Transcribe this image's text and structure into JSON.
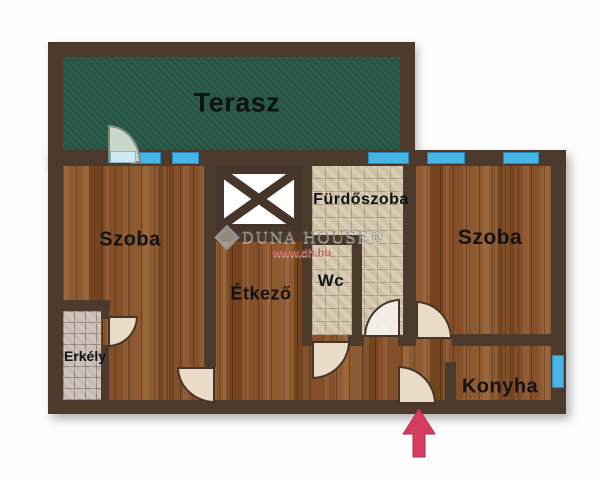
{
  "watermark": {
    "brand_display": "DUNA HOUSE®",
    "url": "www.dh.hu"
  },
  "rooms": [
    {
      "id": "terrace",
      "label": "Terasz"
    },
    {
      "id": "room-left",
      "label": "Szoba"
    },
    {
      "id": "dining",
      "label": "Étkező"
    },
    {
      "id": "bathroom",
      "label": "Fürdőszoba"
    },
    {
      "id": "wc",
      "label": "Wc"
    },
    {
      "id": "room-right",
      "label": "Szoba"
    },
    {
      "id": "balcony",
      "label": "Erkély"
    },
    {
      "id": "kitchen",
      "label": "Konyha"
    }
  ],
  "entrance_marker": {
    "type": "arrow-up",
    "color": "#d63c5e"
  },
  "colors": {
    "wall": "#4c3a2c",
    "terrace_green": "#2c5b49",
    "wood_floor": "#84522c",
    "bath_tile": "#cfc1a6",
    "balcony_tile": "#c8bbb2",
    "window_blue": "#46b5e7",
    "door_beige": "#eadbc6",
    "arrow_red": "#d63c5e"
  }
}
